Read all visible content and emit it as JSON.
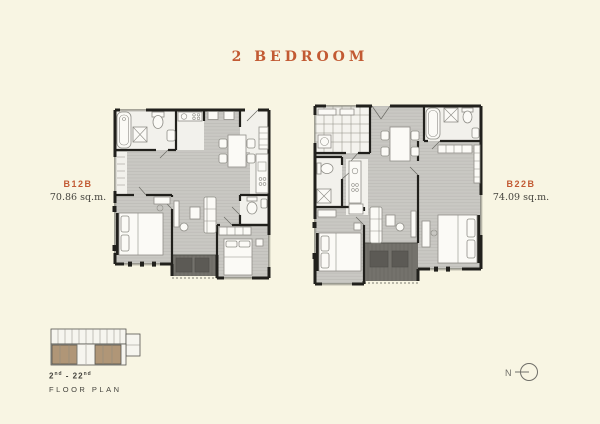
{
  "title": "2 BEDROOM",
  "units": [
    {
      "code": "B12B",
      "area": "70.86 sq.m."
    },
    {
      "code": "B22B",
      "area": "74.09 sq.m."
    }
  ],
  "keyplan": {
    "floors_prefix": "2",
    "floors_sup1": "nd",
    "floors_mid": " - 22",
    "floors_sup2": "nd",
    "caption": "FLOOR PLAN"
  },
  "north_label": "N",
  "colors": {
    "background": "#f8f5e3",
    "accent": "#c25a33",
    "text_dark": "#45443e",
    "wall": "#21201c",
    "floor": "#c9c8c3",
    "floor_stripe": "#b9b8b3",
    "room_white": "#f2f1ec",
    "fixture_stroke": "#8f8e88",
    "balcony": "#74726c",
    "balcony_dark": "#5c5a55",
    "keyplan_tan": "#b09677",
    "north": "#6f6e68"
  }
}
